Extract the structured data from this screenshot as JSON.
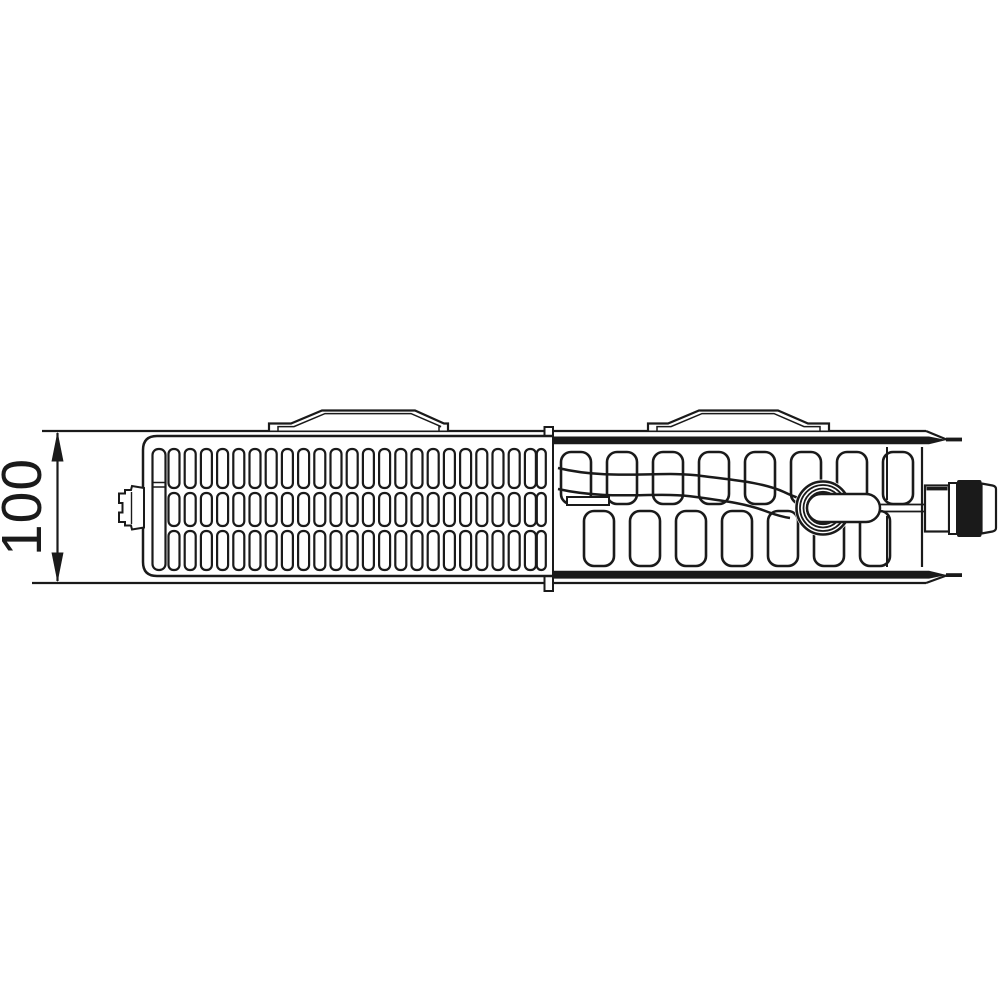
{
  "page": {
    "background": "#ffffff"
  },
  "diagram": {
    "dimension": {
      "label": "100"
    },
    "colors": {
      "line": "#1a1a1a",
      "background": "#ffffff"
    }
  }
}
